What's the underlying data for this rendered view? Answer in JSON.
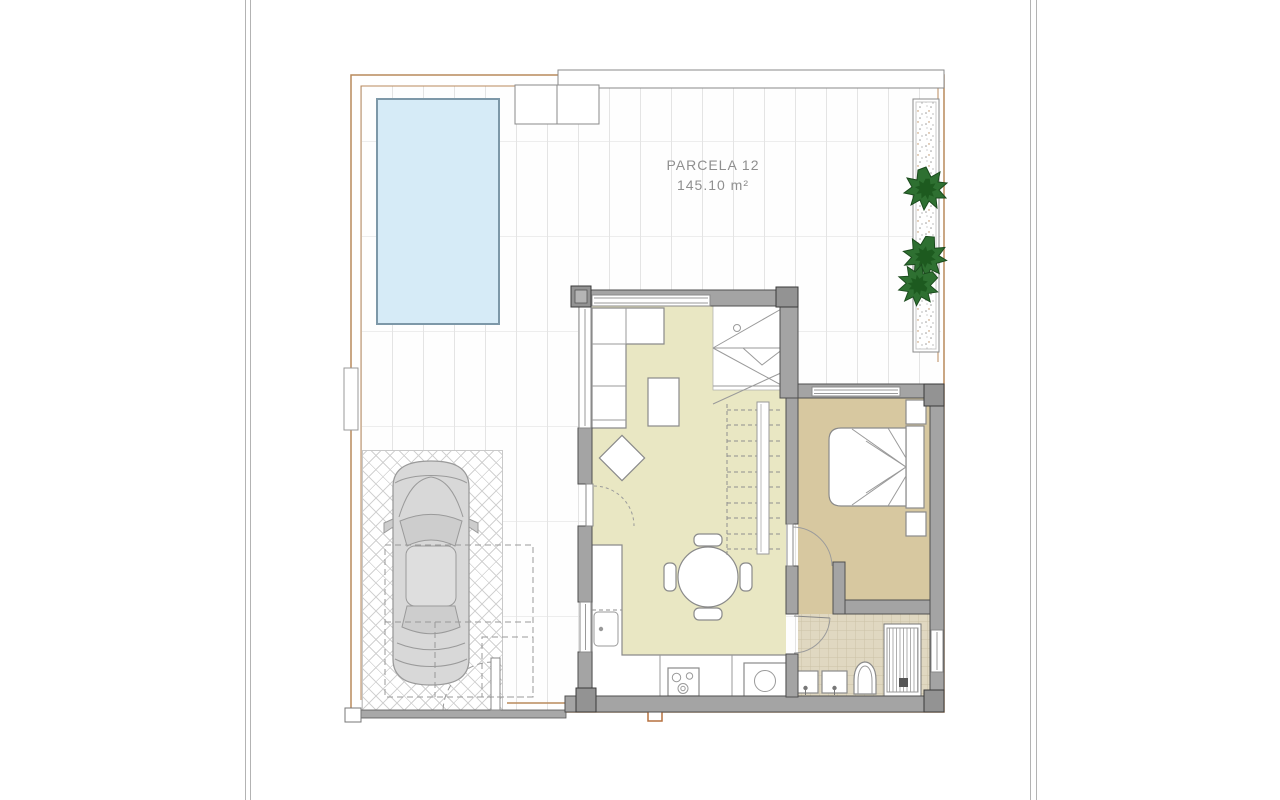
{
  "plan": {
    "parcel_label": "PARCELA 12",
    "area_label": "145.10 m²"
  },
  "colors": {
    "wall": "#a4a4a4",
    "wall_dark": "#939393",
    "floor_living": "#e9e7c3",
    "floor_bedroom": "#d7c8a0",
    "floor_bath": "#e0d8c1",
    "pool_fill": "#d6ebf7",
    "pool_stroke": "#7d98a8",
    "boundary": "#b98a5c",
    "tree": "#2e7031",
    "tree_dark": "#1d5a1f",
    "furniture_stroke": "#8a8a8a",
    "tile_line": "#e4e4e4",
    "herringbone_line": "#d2d2d2",
    "car_body": "#d8d8d8",
    "car_stroke": "#9a9a9a",
    "text": "#8f8f8f"
  }
}
